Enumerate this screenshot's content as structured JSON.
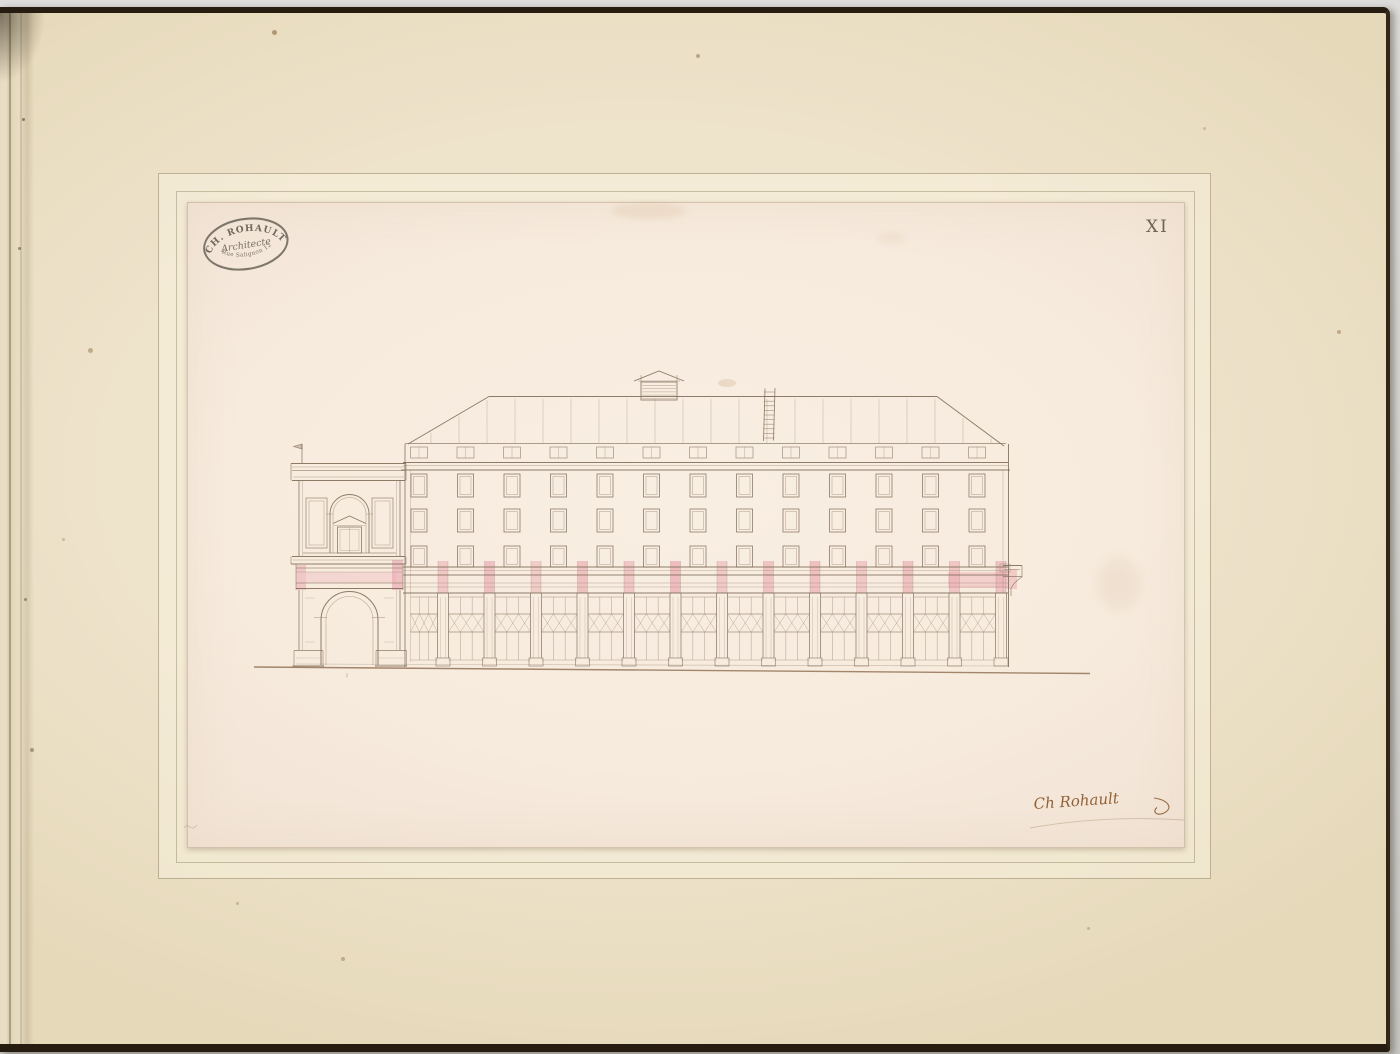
{
  "album": {
    "page_number": "XI",
    "stamp": {
      "top": "CH. ROHAULT",
      "middle": "Architecte",
      "bottom": "Rue Salignon 12"
    },
    "signature": "Ch Rohault"
  },
  "drawing": {
    "type": "architectural-elevation",
    "subject": "Side elevation of a long building with ground-floor arcade, three window storeys, standing-seam hipped roof with ridge vent and ladder, and an arched entrance pavilion at the left end",
    "arcade_posts": 13,
    "window_columns": 13,
    "window_rows": 3,
    "colors": {
      "line": "#94806c",
      "dark_line": "#7a6754",
      "pink": "#e9a3ad",
      "ground": "#8a684a",
      "ink": "#8a5728",
      "stamp": "#4d483f",
      "pencil": "#b49a7c"
    }
  }
}
